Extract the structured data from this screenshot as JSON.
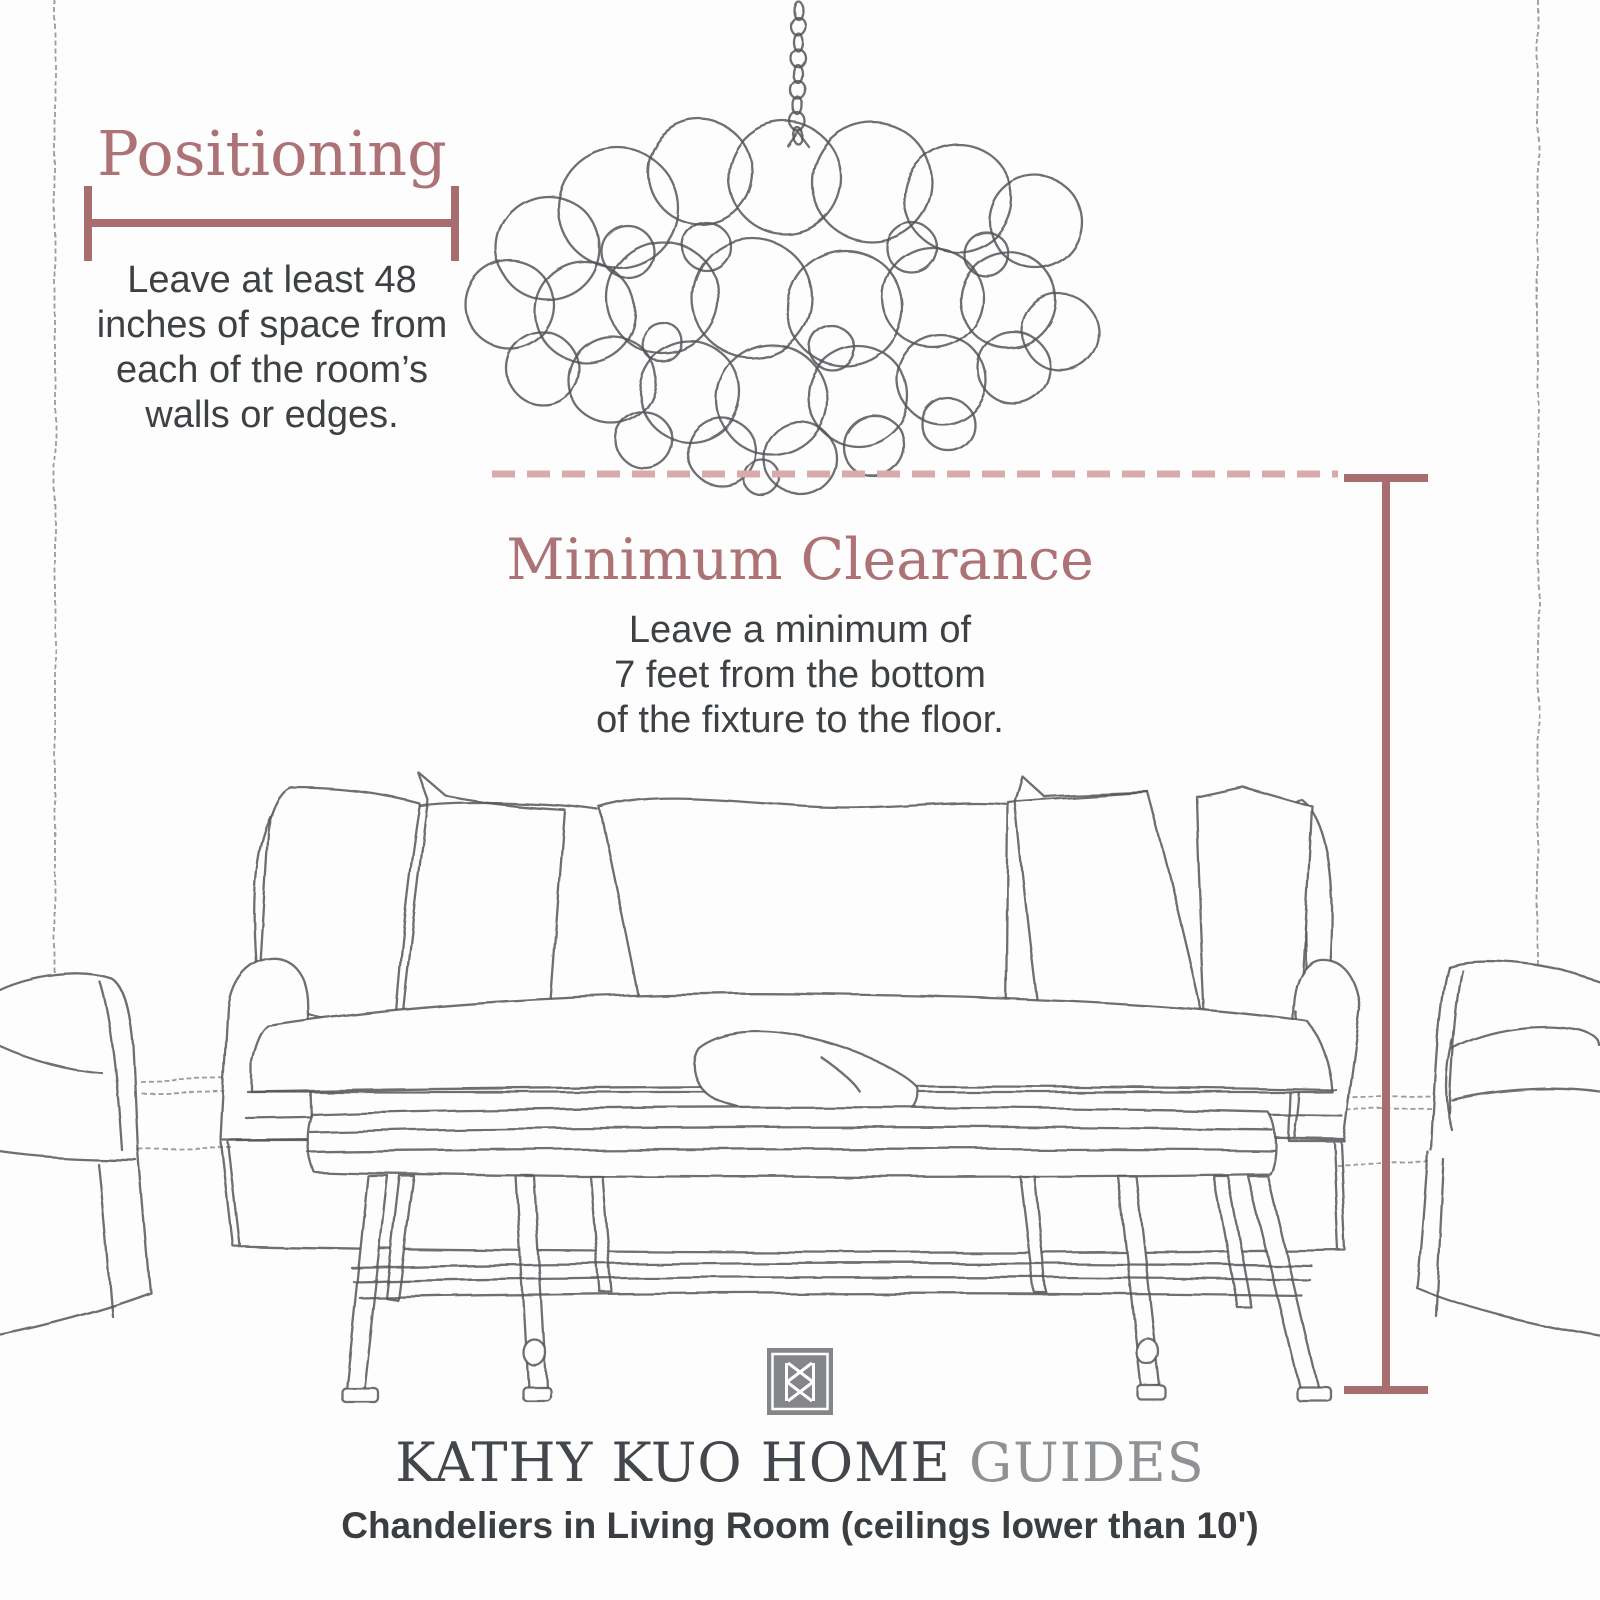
{
  "page": {
    "background": "#fdfdfd"
  },
  "colors": {
    "accent_heading": "#ad7276",
    "measure_line": "#a86d6e",
    "dashed_line": "#d9aaab",
    "body_text": "#3e4144",
    "brand_text": "#43464a",
    "brand_muted": "#8f9295",
    "sketch_line": "#54565a",
    "logo_gray": "#84868a"
  },
  "positioning": {
    "title": "Positioning",
    "description": "Leave at least 48\ninches of space from\neach of the room’s\nwalls or edges."
  },
  "clearance": {
    "title": "Minimum Clearance",
    "description": "Leave a minimum of\n7 feet from the bottom\nof the fixture to the floor."
  },
  "footer": {
    "brand_primary": "KATHY KUO HOME",
    "brand_secondary": "GUIDES",
    "subtitle": "Chandeliers in Living Room (ceilings lower than 10')"
  }
}
